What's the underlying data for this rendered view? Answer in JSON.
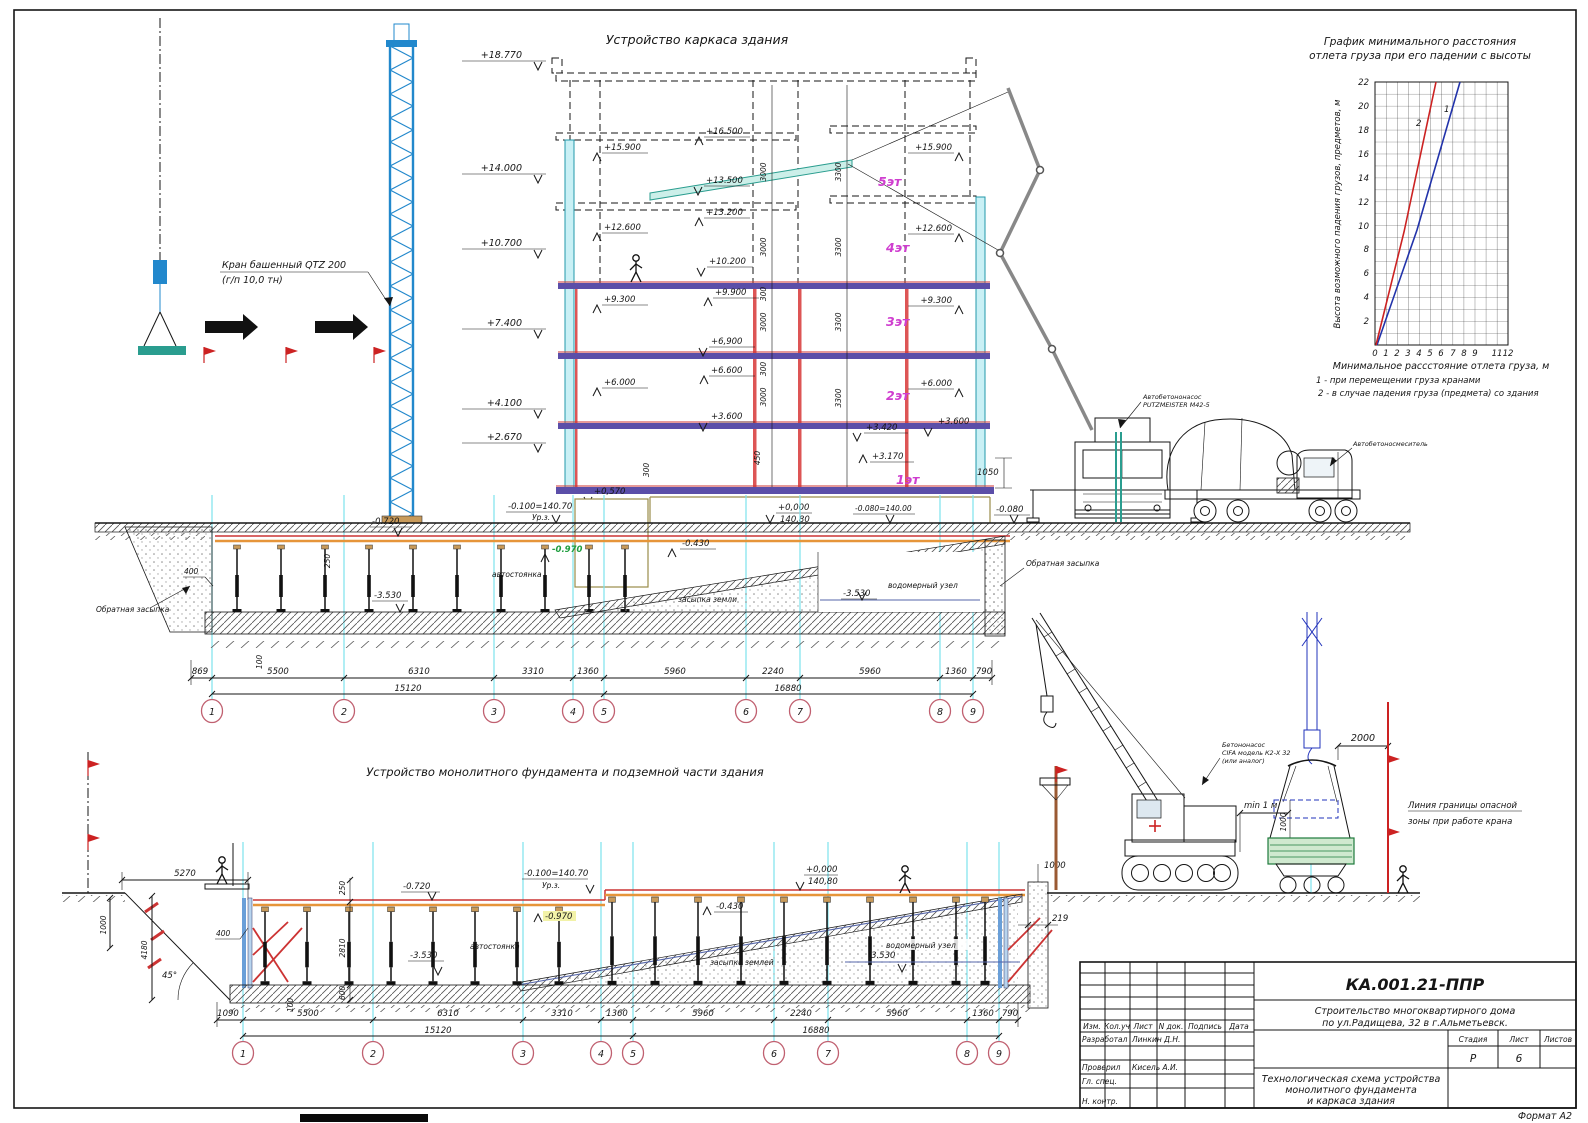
{
  "sheet": {
    "format": "Формат А2"
  },
  "titles": {
    "upper": "Устройство каркаса здания",
    "lower": "Устройство монолитного фундамента и подземной части здания"
  },
  "crane": {
    "l1": "Кран башенный QTZ 200",
    "l2": "(г/п 10,0 тн)"
  },
  "chart": {
    "t1": "График минимального расстояния",
    "t2": "отлета груза при его падении с высоты",
    "ylab": "Высота возможного падения грузов, предметов, м",
    "xlab": "Минимальное рассстояние отлета груза, м",
    "leg1": "1 - при перемещении груза кранами",
    "leg2": "2 - в случае падения груза (предмета) со здания",
    "n1": "1",
    "n2": "2",
    "yticks": [
      "22",
      "20",
      "18",
      "16",
      "14",
      "12",
      "10",
      "8",
      "6",
      "4",
      "2"
    ],
    "xticks": [
      "0",
      "1",
      "2",
      "3",
      "4",
      "5",
      "6",
      "7",
      "8",
      "9",
      "11",
      "12"
    ]
  },
  "chart_data": {
    "type": "line",
    "title": "График минимального расстояния отлета груза при его падении с высоты",
    "xlabel": "Минимальное рассстояние отлета груза, м",
    "ylabel": "Высота возможного падения грузов, предметов, м",
    "xlim": [
      0,
      12
    ],
    "ylim": [
      0,
      22
    ],
    "grid": true,
    "legend_position": "below",
    "series": [
      {
        "name": "1 - при перемещении груза кранами",
        "color": "#2233aa",
        "points": [
          [
            0,
            0
          ],
          [
            3.8,
            10
          ],
          [
            7.7,
            22
          ]
        ]
      },
      {
        "name": "2 - в случае падения груза (предмета) со здания",
        "color": "#cc2222",
        "points": [
          [
            0,
            0
          ],
          [
            2.8,
            10
          ],
          [
            5.5,
            22
          ]
        ]
      }
    ]
  },
  "bld": {
    "floors": [
      "5эт",
      "4эт",
      "3эт",
      "2эт",
      "1эт"
    ],
    "elev_left": [
      "+18.770",
      "+14.000",
      "+10.700",
      "+7.400",
      "+4.100",
      "+2.670"
    ],
    "elev_inner": [
      "+15.900",
      "+12.600",
      "+9.300",
      "+6.000",
      "+0,570"
    ],
    "elev_center": [
      "+16.500",
      "+13.500",
      "+13.200",
      "+10.200",
      "+9.900",
      "+6,900",
      "+6.600",
      "+3.600",
      "+3.420",
      "+3.170"
    ],
    "elev_right": [
      "+15.900",
      "+12.600",
      "+9.300",
      "+6.000",
      "+3.600",
      "-0.080"
    ],
    "zero": "+0,000",
    "zero_abs": "140,80",
    "m080": "-0.080=140.00",
    "dim1050": "1050",
    "h3000": "3000",
    "h300": "300",
    "h3300": "3300",
    "v450": "450"
  },
  "pump": {
    "l1": "Автобетононасос",
    "l2": "PUTZMEISTER M42-5"
  },
  "mixer": {
    "l": "Автобетоносмеситель"
  },
  "fnd1": {
    "backfill": "Обратная засыпка",
    "backfill2": "Обратная засыпка",
    "parking": "автостоянка",
    "soil": "засыпка земли",
    "water": "водомерный узел",
    "e0720": "-0.720",
    "urz": "-0.100=140.70",
    "urz2": "Ур.з.",
    "e0970": "-0.970",
    "e0430": "-0.430",
    "e3530": "-3.530",
    "d400": "400",
    "d250": "250",
    "d100": "100"
  },
  "dims1": {
    "v": [
      "869",
      "5500",
      "6310",
      "3310",
      "1360",
      "5960",
      "2240",
      "5960",
      "1360",
      "790"
    ],
    "t": [
      "15120",
      "16880"
    ],
    "a": [
      "1",
      "2",
      "3",
      "4",
      "5",
      "6",
      "7",
      "8",
      "9"
    ]
  },
  "fnd2": {
    "d5270": "5270",
    "d1000": "1000",
    "d4180": "4180",
    "ang": "45°",
    "d400": "400",
    "d250": "250",
    "d2810": "2810",
    "d600": "600",
    "e0720": "-0.720",
    "urz": "-0.100=140.70",
    "urz2": "Ур.з.",
    "e0970": "-0.970",
    "e3530": "-3.530",
    "parking": "автостоянка",
    "zero": "+0,000",
    "zero_abs": "140,80",
    "e0430": "-0.430",
    "soil": "засыпка землей",
    "water": "водомерный узел",
    "e3530b": "-3.530",
    "d219": "219",
    "d1000b": "1000",
    "d100": "100"
  },
  "dims2": {
    "v": [
      "1090",
      "5500",
      "6310",
      "3310",
      "1360",
      "5960",
      "2240",
      "5960",
      "1360",
      "790"
    ],
    "t": [
      "15120",
      "16880"
    ],
    "a": [
      "1",
      "2",
      "3",
      "4",
      "5",
      "6",
      "7",
      "8",
      "9"
    ]
  },
  "site": {
    "p1": "Бетононасос",
    "p2": "CIFA модель К2-Х 32",
    "p3": "(или аналог)",
    "min": "min 1 м",
    "d2000": "2000",
    "d1000": "1000",
    "dang1": "Линия границы опасной",
    "dang2": "зоны при работе крана"
  },
  "tb": {
    "num": "КА.001.21-ППР",
    "pr1": "Строительство многоквартирного дома",
    "pr2": "по  ул.Радищева, 32 в г.Альметьевск.",
    "nm1": "Технологическая схема устройства",
    "nm2": "монолитного фундамента",
    "nm3": "и каркаса здания",
    "cols": [
      "Изм.",
      "Кол.уч",
      "Лист",
      "N док.",
      "Подпись",
      "Дата"
    ],
    "r1": "Разработал",
    "r2": "Проверил",
    "r3": "Гл. спец.",
    "r4": "Н. контр.",
    "n1": "Линкин Д.Н.",
    "n2": "Кисель А.И.",
    "stadia": "Стадия",
    "list": "Лист",
    "listov": "Листов",
    "st": "Р",
    "ln": "6"
  }
}
